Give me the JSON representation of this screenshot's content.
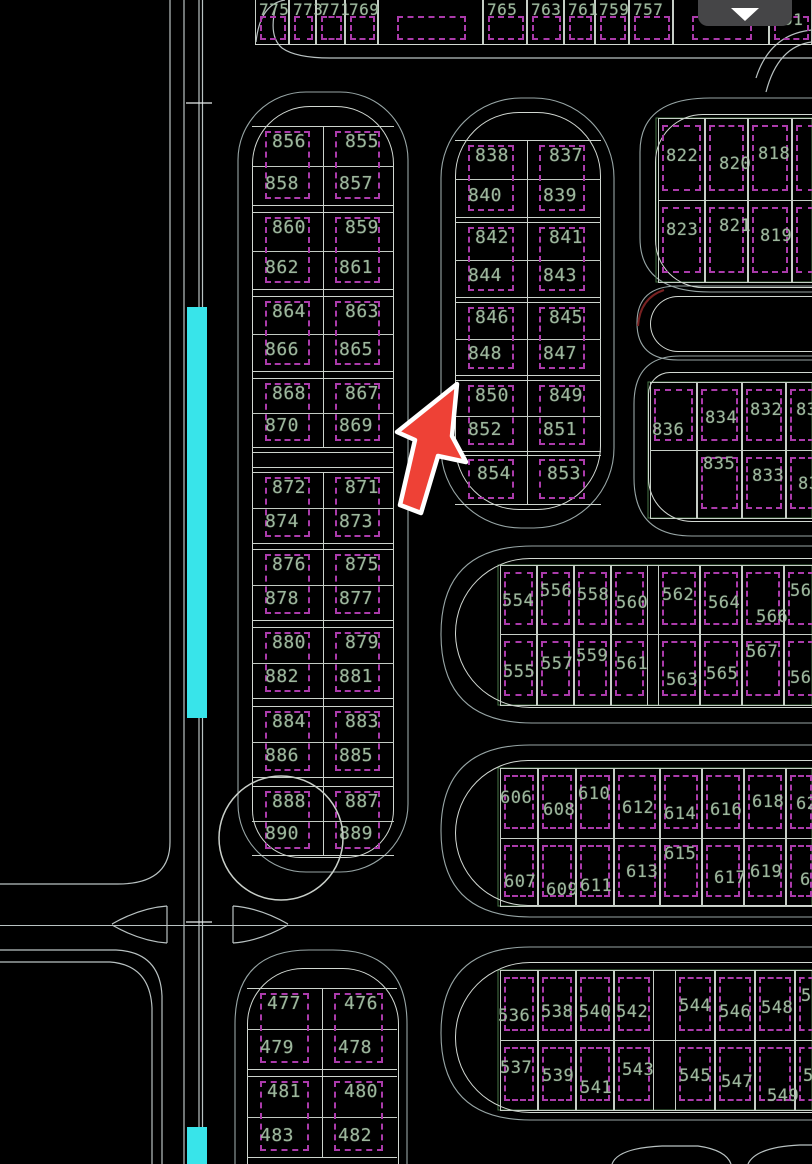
{
  "toolbar": {
    "dropdown_icon": "chevron-down"
  },
  "annotations": {
    "selection_arrow": "red arrow pointing at parcels 850/852",
    "highlight_strip": "cyan highlighted road segment along left street",
    "survey_circle": "construction circle over parcels 887-890"
  },
  "colors": {
    "background": "#000000",
    "highlight_cyan": "#38e4ea",
    "parcel_dash_magenta": "#ab3bab",
    "number_green": "#9db79d",
    "arrow_red": "#ee4136",
    "linework_white": "#d2d8d2",
    "button_gray": "#454547"
  },
  "blocks": {
    "top_strip": {
      "labels": [
        "775",
        "773",
        "771",
        "769",
        "",
        "765",
        "763",
        "761",
        "759",
        "757",
        "",
        "751"
      ]
    },
    "block_856_870": {
      "rows": [
        [
          "856",
          "855"
        ],
        [
          "858",
          "857"
        ],
        [
          "860",
          "859"
        ],
        [
          "862",
          "861"
        ],
        [
          "864",
          "863"
        ],
        [
          "866",
          "865"
        ],
        [
          "868",
          "867"
        ],
        [
          "870",
          "869"
        ]
      ]
    },
    "block_872_890": {
      "rows": [
        [
          "872",
          "871"
        ],
        [
          "874",
          "873"
        ],
        [
          "876",
          "875"
        ],
        [
          "878",
          "877"
        ],
        [
          "880",
          "879"
        ],
        [
          "882",
          "881"
        ],
        [
          "884",
          "883"
        ],
        [
          "886",
          "885"
        ],
        [
          "888",
          "887"
        ],
        [
          "890",
          "889"
        ]
      ]
    },
    "block_838_854": {
      "rows": [
        [
          "838",
          "837"
        ],
        [
          "840",
          "839"
        ],
        [
          "842",
          "841"
        ],
        [
          "844",
          "843"
        ],
        [
          "846",
          "845"
        ],
        [
          "848",
          "847"
        ],
        [
          "850",
          "849"
        ],
        [
          "852",
          "851"
        ],
        [
          "854",
          "853"
        ]
      ]
    },
    "block_818_823": {
      "rows": [
        [
          "822",
          "820",
          "818"
        ],
        [
          "823",
          "821",
          "819"
        ]
      ]
    },
    "block_830_836": {
      "rows": [
        [
          "836",
          "834",
          "832",
          "830"
        ],
        [
          "",
          "835",
          "833",
          "831"
        ]
      ]
    },
    "block_554_569": {
      "rows": [
        [
          "554",
          "556",
          "558",
          "560",
          "562",
          "564",
          "566",
          "568"
        ],
        [
          "555",
          "557",
          "559",
          "561",
          "563",
          "565",
          "567",
          "569"
        ]
      ]
    },
    "block_606_621": {
      "rows": [
        [
          "606",
          "608",
          "610",
          "612",
          "614",
          "616",
          "618",
          "620"
        ],
        [
          "607",
          "609",
          "611",
          "613",
          "615",
          "617",
          "619",
          "621"
        ]
      ]
    },
    "block_476_483": {
      "rows": [
        [
          "477",
          "476"
        ],
        [
          "479",
          "478"
        ],
        [
          "481",
          "480"
        ],
        [
          "483",
          "482"
        ]
      ]
    },
    "block_536_551": {
      "rows": [
        [
          "536",
          "538",
          "540",
          "542",
          "544",
          "546",
          "548",
          "550"
        ],
        [
          "537",
          "539",
          "541",
          "543",
          "545",
          "547",
          "549",
          "551"
        ]
      ]
    }
  }
}
